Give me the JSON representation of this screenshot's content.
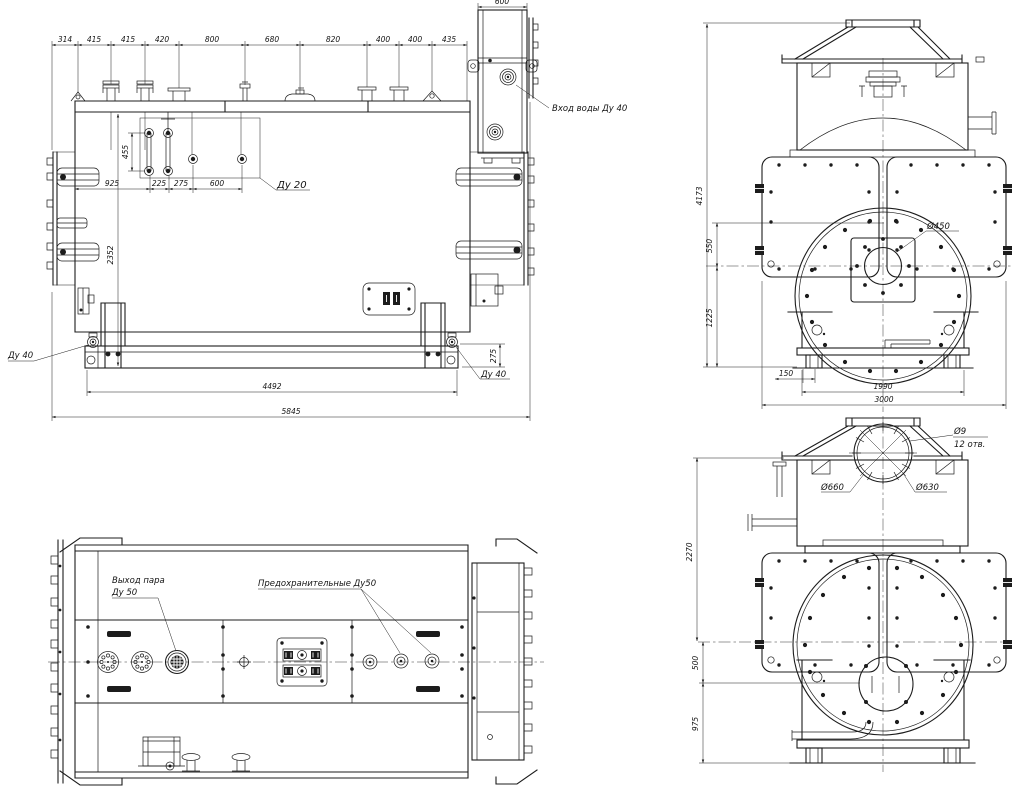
{
  "side_view": {
    "top_dims": [
      "314",
      "415",
      "415",
      "420",
      "800",
      "680",
      "820",
      "400",
      "400",
      "435"
    ],
    "economizer_width_dim": "600",
    "nozzle_group_dims": [
      "925",
      "225",
      "275",
      "600"
    ],
    "nozzle_vertical_dim": "455",
    "height_dim": "2352",
    "skid_height_dim": "275",
    "skid_length_dim": "4492",
    "overall_length_dim": "5845",
    "label_du20": "Ду 20",
    "label_du40_front": "Ду 40",
    "label_du40_rear": "Ду 40",
    "label_water_inlet": "Вход воды Ду 40"
  },
  "front_view": {
    "overall_height_dim": "4173",
    "upper_dim": "550",
    "lower_dim": "1225",
    "foot_offset_dim": "150",
    "base_width_dim": "1990",
    "overall_width_dim": "3000",
    "burner_opening_label": "Ø450"
  },
  "rear_view": {
    "upper_height_dim": "2270",
    "manhole_offset_dim": "500",
    "base_height_dim": "975",
    "flue_outer_label": "Ø660",
    "flue_inner_label": "Ø630",
    "holes_dia_label": "Ø9",
    "holes_count_label": "12 отв."
  },
  "top_view": {
    "steam_outlet_label_line1": "Выход пара",
    "steam_outlet_label_line2": "Ду 50",
    "safety_valves_label": "Предохранительные Ду50"
  }
}
